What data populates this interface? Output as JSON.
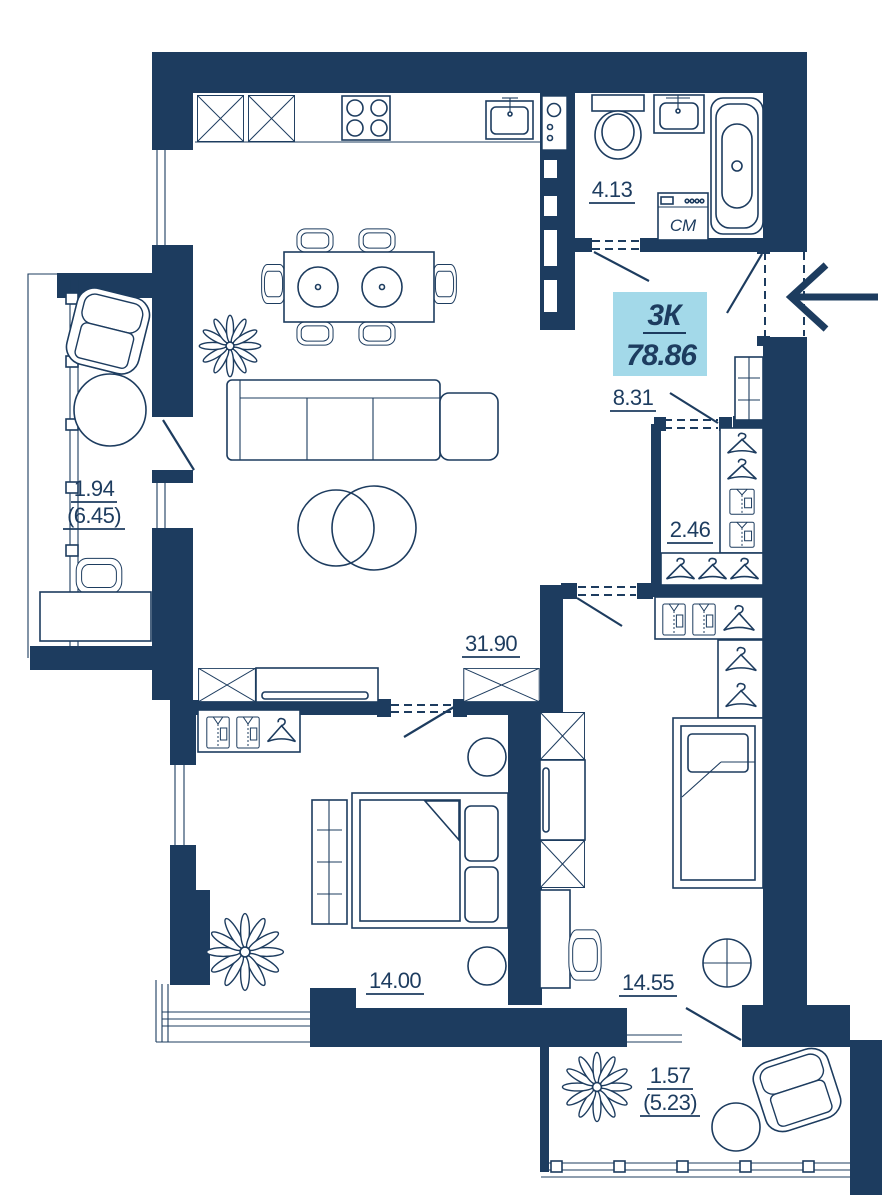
{
  "badge": {
    "unit_type": "3К",
    "total_area": "78.86"
  },
  "rooms": {
    "bathroom": {
      "area": "4.13"
    },
    "hall": {
      "area": "8.31"
    },
    "wardrobe": {
      "area": "2.46"
    },
    "kitchen_living": {
      "area": "31.90"
    },
    "bedroom_main": {
      "area": "14.00"
    },
    "bedroom_second": {
      "area": "14.55"
    },
    "loggia_left": {
      "area": "1.94",
      "area_weighted": "(6.45)"
    },
    "loggia_bottom": {
      "area": "1.57",
      "area_weighted": "(5.23)"
    }
  },
  "appliances": {
    "washing_machine_label": "СМ"
  },
  "colors": {
    "wall_navy": "#1d3c5f",
    "badge_bg": "#a3d9e9",
    "background": "#ffffff"
  }
}
